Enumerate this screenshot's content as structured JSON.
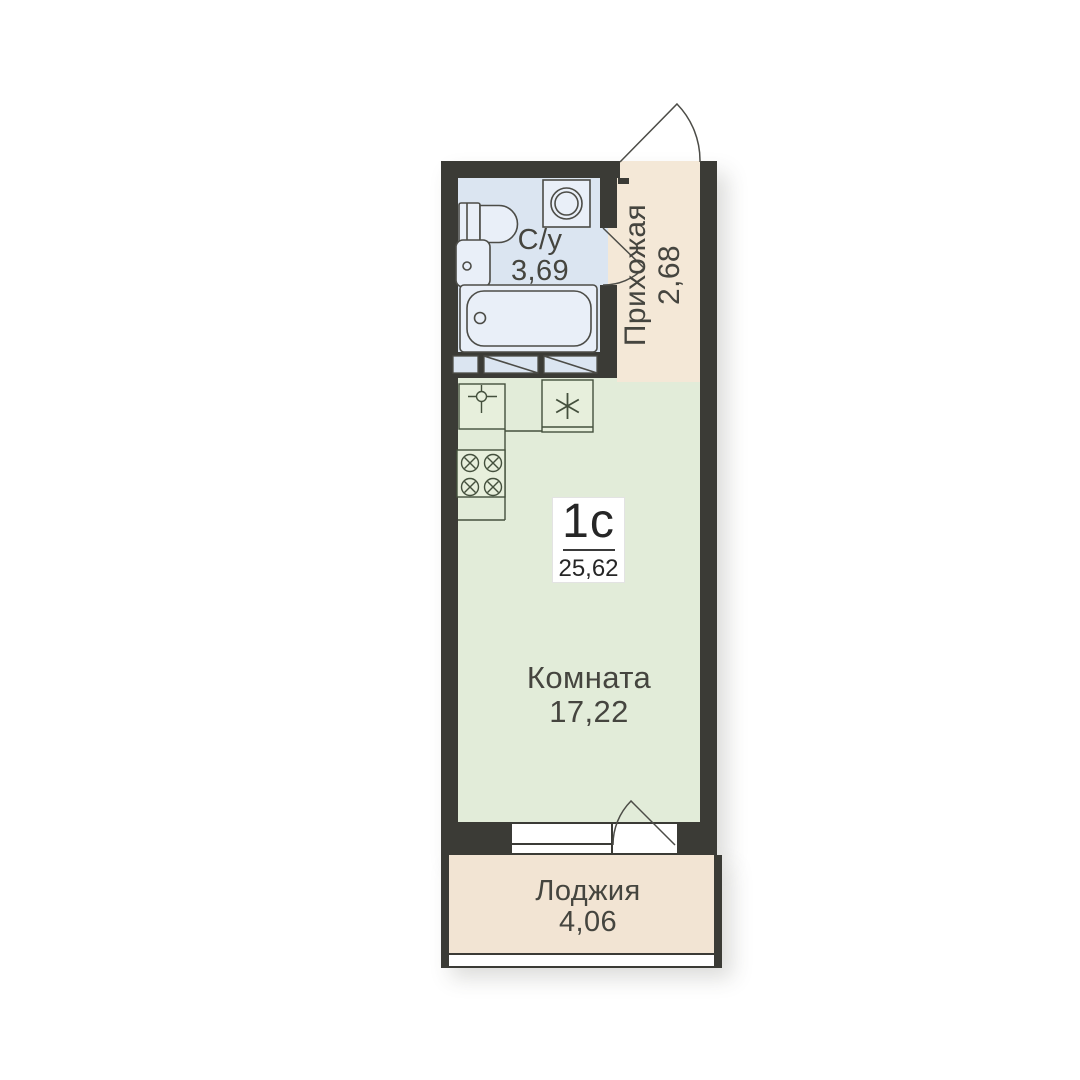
{
  "unit": {
    "type": "1с",
    "total_area": "25,62"
  },
  "rooms": {
    "bathroom": {
      "name": "С/у",
      "area": "3,69"
    },
    "hallway": {
      "name": "Прихожая",
      "area": "2,68"
    },
    "living": {
      "name": "Комната",
      "area": "17,22"
    },
    "loggia": {
      "name": "Лоджия",
      "area": "4,06"
    }
  },
  "colors": {
    "wall": "#3b3b36",
    "bathroom_floor": "#dbe5f1",
    "hallway_floor": "#f4e8d7",
    "room_floor": "#e2ecd9",
    "loggia_floor": "#f2e4d3",
    "fixture_stroke": "#4c4c47",
    "fixture_fill": "#e9eff8",
    "counter_stroke": "#44503d",
    "counter_fill": "#e7efdc",
    "text": "#45453f",
    "badge_bg": "#ffffff",
    "badge_text": "#262626"
  }
}
